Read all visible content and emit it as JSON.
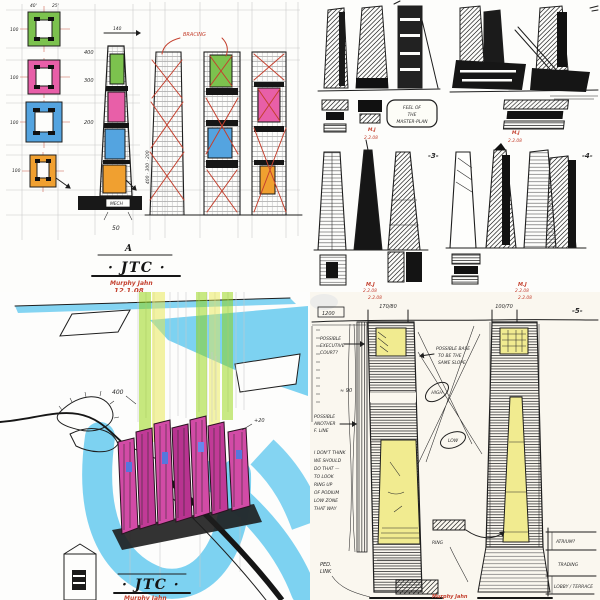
{
  "meta": {
    "project": "JTC",
    "firm": "Murphy Jahn"
  },
  "colors": {
    "paper": "#fdfdfb",
    "paper_warm": "#faf7ef",
    "green": "#7cc24e",
    "pink": "#e85fa8",
    "blue": "#54a4e0",
    "orange": "#f0a030",
    "yellow": "#f1eb90",
    "cyan": "#6fcdf0",
    "magenta": "#d24ba6",
    "red_ink": "#c4402e",
    "black_ink": "#1e1e1e",
    "pencil": "#c8c8c8"
  },
  "top_left": {
    "top_dims": [
      "40'",
      "25'",
      "140"
    ],
    "floor_dims": [
      "100",
      "100",
      "100",
      "100"
    ],
    "elev_dims": [
      "400",
      "300",
      "200"
    ],
    "side_dims": "400 · 300 · 200",
    "bracing_note": "BRACING",
    "podium_label": "MECH",
    "base_dim": "50",
    "series_letter": "A",
    "title": "· JTC ·",
    "firm": "Murphy Jahn",
    "date": "12.1.08"
  },
  "top_right": {
    "box_note_lines": [
      "FEEL OF",
      "THE",
      "MASTER-PLAN"
    ],
    "group_labels": [
      "-3-",
      "-4-"
    ],
    "signature": "M.J",
    "sig_dates": [
      "2.2.08",
      "2.2.08",
      "2.2.08",
      "2.2.08"
    ]
  },
  "bottom_left": {
    "dim_400": "400",
    "dim_20": "+20",
    "title": "· JTC ·",
    "firm": "Murphy Jahn",
    "date": "12.1.08"
  },
  "bottom_right": {
    "top_dates": [
      "2.2.08",
      "2.2.08"
    ],
    "datum_label": "1200",
    "dim_left": "170/80",
    "dim_right": "100/70",
    "sheet_no": "-5-",
    "note_exec": [
      "POSSIBLE",
      "EXECUTIVE",
      "COURT?"
    ],
    "dim_90": "≈ 90",
    "note_fline": [
      "POSSIBLE",
      "ANOTHER",
      "F. LINE"
    ],
    "note_block": [
      "I DON'T THINK",
      "WE SHOULD",
      "DO THAT —",
      "TO LOOK",
      "RING UP",
      "OF PODIUM",
      "LOW ZONE",
      "THAT WAY"
    ],
    "note_base": [
      "POSSIBLE BASE",
      "TO BE THE",
      "SAME SLOPE"
    ],
    "oval_high": "HIGH",
    "oval_low": "LOW",
    "word_ring": "RING",
    "note_ped": [
      "PED.",
      "LINK"
    ],
    "margin_notes": [
      "ATRIUM?",
      "TRADING",
      "LOBBY / TERRACE"
    ],
    "firm": "Murphy Jahn"
  }
}
